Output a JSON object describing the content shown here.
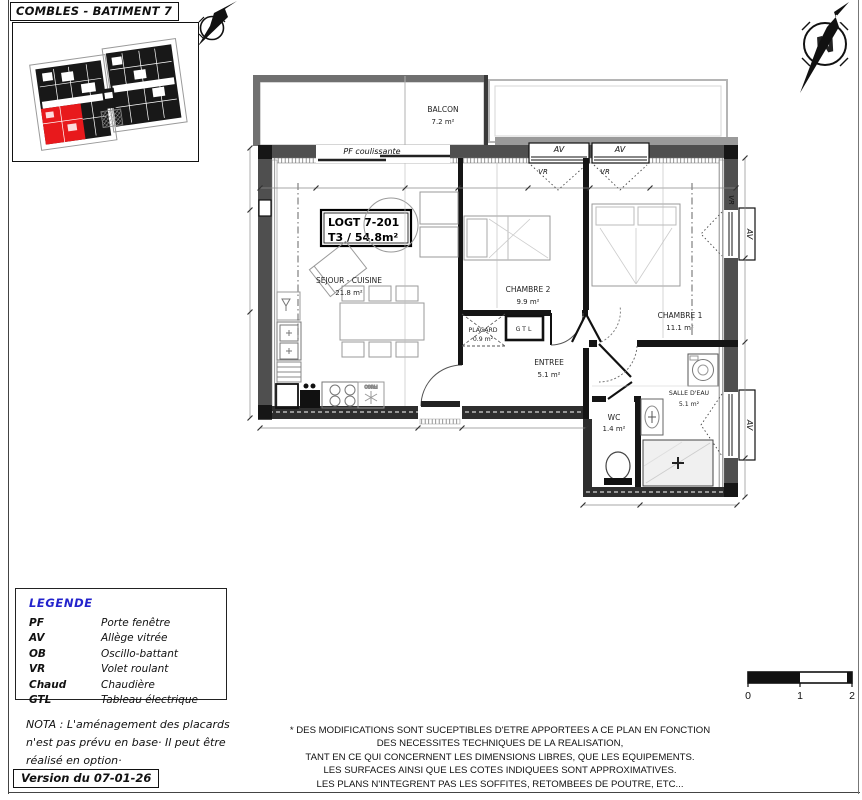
{
  "title": "COMBLES - BATIMENT 7",
  "north_letter": "N",
  "plan": {
    "unit": {
      "id": "LOGT 7-201",
      "type_surface": "T3 / 54.8m²"
    },
    "rooms": {
      "balcon": {
        "name": "BALCON",
        "area": "7.2 m²"
      },
      "sejour": {
        "name": "SEJOUR - CUISINE",
        "area": "21.8 m²"
      },
      "chambre2": {
        "name": "CHAMBRE 2",
        "area": "9.9 m²"
      },
      "chambre1": {
        "name": "CHAMBRE 1",
        "area": "11.1 m²"
      },
      "placard": {
        "name": "PLACARD",
        "area": "0.9 m²"
      },
      "entree": {
        "name": "ENTREE",
        "area": "5.1 m²"
      },
      "wc": {
        "name": "WC",
        "area": "1.4 m²"
      },
      "salle_eau": {
        "name": "SALLE D'EAU",
        "area": "5.1 m²"
      }
    },
    "labels": {
      "pf": "PF coulissante",
      "av": "AV",
      "vr": "VR",
      "gtl": "GTL",
      "frigo": "FRIGO"
    }
  },
  "legend": {
    "heading": "LEGENDE",
    "items": [
      {
        "abbr": "PF",
        "label": "Porte fenêtre"
      },
      {
        "abbr": "AV",
        "label": "Allège vitrée"
      },
      {
        "abbr": "OB",
        "label": "Oscillo-battant"
      },
      {
        "abbr": "VR",
        "label": "Volet roulant"
      },
      {
        "abbr": "Chaud",
        "label": "Chaudière"
      },
      {
        "abbr": "GTL",
        "label": "Tableau électrique"
      }
    ]
  },
  "nota": {
    "line1": "NOTA : L'aménagement des placards",
    "line2": "n'est pas prévu en base· Il peut être",
    "line3": "réalisé en option·"
  },
  "version": "Version du 07-01-26",
  "disclaimer": {
    "line1": "* DES MODIFICATIONS SONT SUCEPTIBLES D'ETRE APPORTEES A CE PLAN EN FONCTION",
    "line2": "DES NECESSITES TECHNIQUES DE LA REALISATION,",
    "line3": "TANT EN CE QUI CONCERNENT LES DIMENSIONS LIBRES, QUE LES EQUIPEMENTS.",
    "line4": "LES SURFACES AINSI QUE LES COTES INDIQUEES SONT APPROXIMATIVES.",
    "line5": "LES PLANS N'INTEGRENT PAS LES SOFFITES, RETOMBEES DE POUTRE, ETC..."
  },
  "scalebar": {
    "t0": "0",
    "t1": "1",
    "t2": "2"
  },
  "colors": {
    "highlight_red": "#e8191c",
    "legend_blue": "#2323cc",
    "wall_gray": "#4f4f4f"
  }
}
